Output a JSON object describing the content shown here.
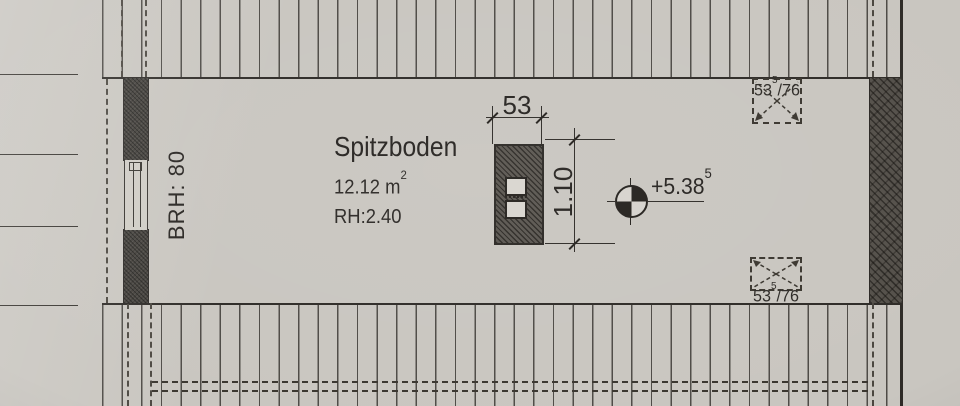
{
  "plan": {
    "room": {
      "name": "Spitzboden",
      "area_value": "12.12 m",
      "area_sup": "2",
      "room_height": "RH:2.40"
    },
    "left_window": {
      "sill_label": "BRH: 80"
    },
    "dimensions": {
      "chimney_width": "53",
      "chimney_depth": "1.10"
    },
    "elevation": {
      "value": "+5.38",
      "sup": "5"
    },
    "roof_window_top": {
      "size": "53",
      "sup": "5",
      "rest": "/76"
    },
    "roof_window_bottom": {
      "size": "53",
      "sup": "5",
      "rest": "/76"
    },
    "colors": {
      "paper": "#c9c6c0",
      "ink": "#2e2b27",
      "wall": "#403d38"
    }
  }
}
